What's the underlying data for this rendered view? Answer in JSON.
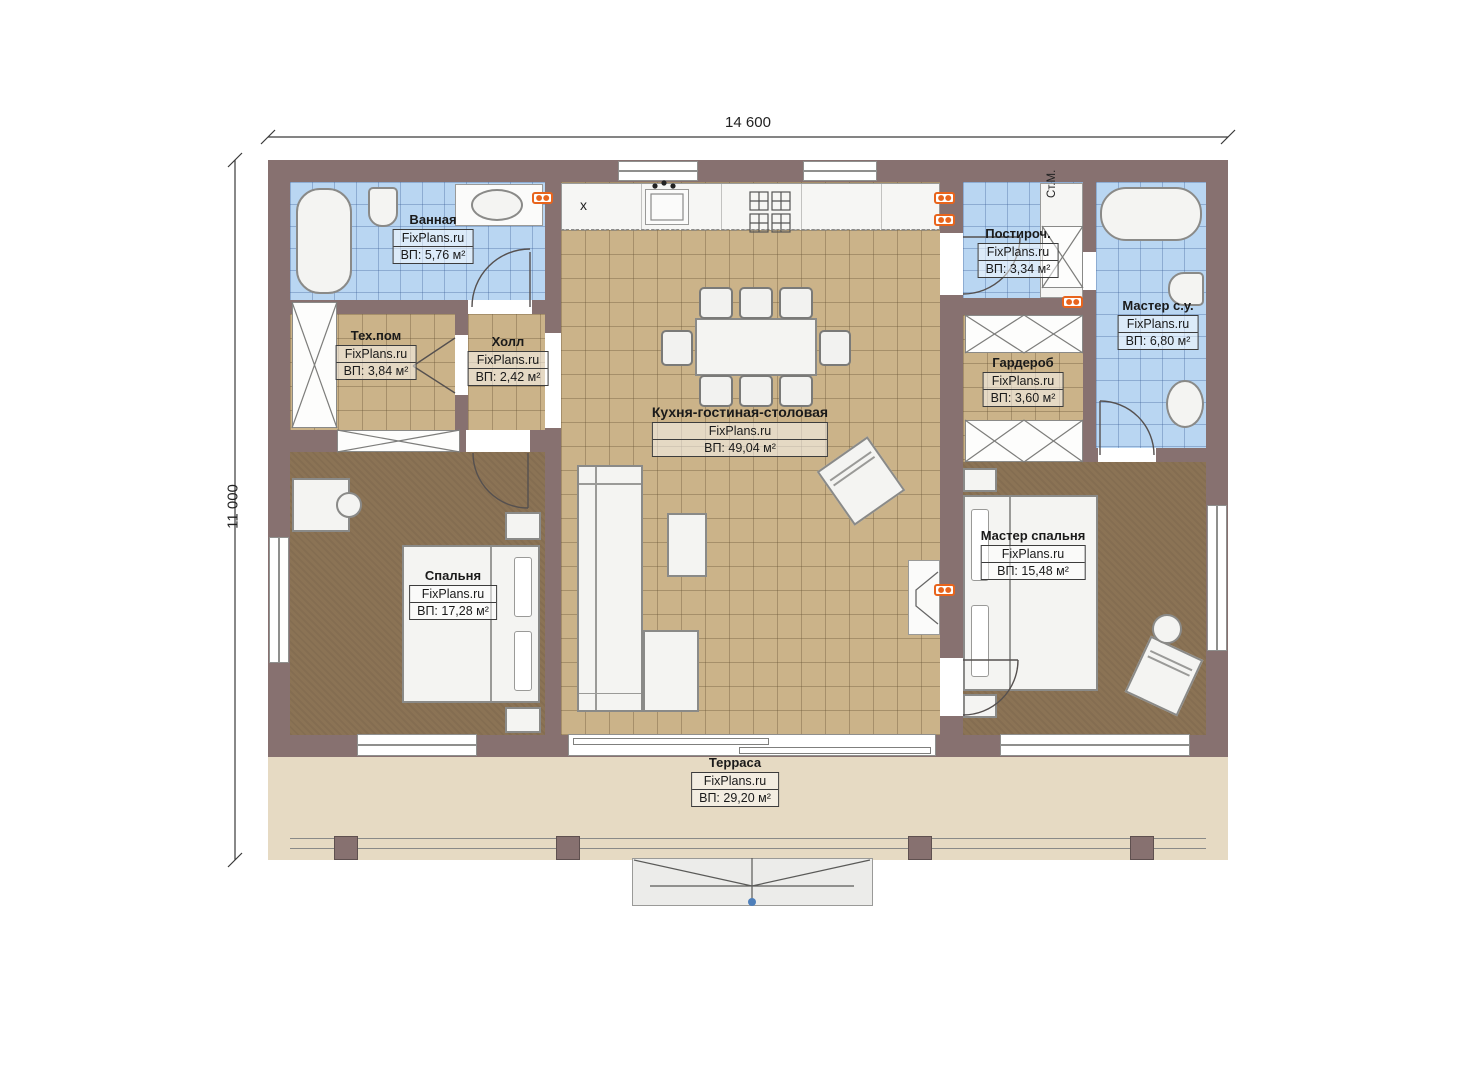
{
  "plan_title": "Floor plan",
  "dimensions": {
    "width_label": "14 600",
    "height_label": "11 000"
  },
  "rooms": [
    {
      "id": "bathroom",
      "name": "Ванная",
      "watermark": "FixPlans.ru",
      "area": "ВП: 5,76 м²"
    },
    {
      "id": "tech-room",
      "name": "Тех.пом",
      "watermark": "FixPlans.ru",
      "area": "ВП: 3,84 м²"
    },
    {
      "id": "hall",
      "name": "Холл",
      "watermark": "FixPlans.ru",
      "area": "ВП: 2,42 м²"
    },
    {
      "id": "kitchen-living",
      "name": "Кухня-гостиная-столовая",
      "watermark": "FixPlans.ru",
      "area": "ВП: 49,04 м²"
    },
    {
      "id": "laundry",
      "name": "Постироч.",
      "watermark": "FixPlans.ru",
      "area": "ВП: 3,34 м²"
    },
    {
      "id": "master-bath",
      "name": "Мастер с.у.",
      "watermark": "FixPlans.ru",
      "area": "ВП: 6,80 м²"
    },
    {
      "id": "wardrobe",
      "name": "Гардероб",
      "watermark": "FixPlans.ru",
      "area": "ВП: 3,60 м²"
    },
    {
      "id": "bedroom",
      "name": "Спальня",
      "watermark": "FixPlans.ru",
      "area": "ВП: 17,28 м²"
    },
    {
      "id": "master-bedroom",
      "name": "Мастер спальня",
      "watermark": "FixPlans.ru",
      "area": "ВП: 15,48 м²"
    },
    {
      "id": "terrace",
      "name": "Терраса",
      "watermark": "FixPlans.ru",
      "area": "ВП: 29,20 м²"
    }
  ],
  "annotations": {
    "washing_machine_label": "Ст.М.",
    "kitchen_mark": "x"
  },
  "colors": {
    "wall": "#877170",
    "tile_floor": "#cbb389",
    "wood_floor": "#8b7355",
    "bath_tile": "#b9d6f2",
    "terrace": "#e6dac3",
    "outlet_accent": "#e8641c",
    "marker_blue": "#4e7fba"
  }
}
